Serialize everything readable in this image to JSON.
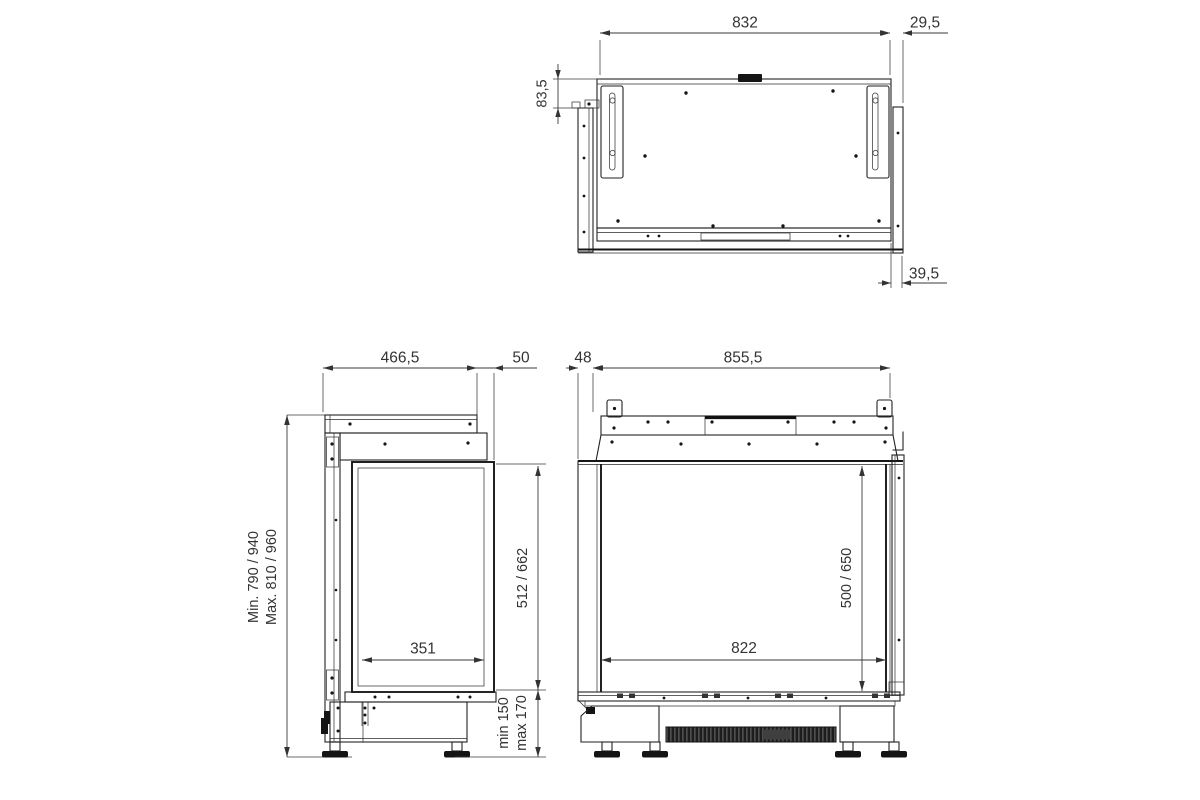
{
  "colors": {
    "background": "#ffffff",
    "line": "#222222",
    "dimension": "#3a3a3a"
  },
  "dims": {
    "top_width": "832",
    "top_right_upper": "29,5",
    "top_side_inset": "83,5",
    "top_right_lower": "39,5",
    "side_depth": "466,5",
    "side_glass_offset": "50",
    "side_height_min": "Min. 790 / 940",
    "side_height_max": "Max. 810 / 960",
    "side_glass_width": "351",
    "side_glass_height": "512 / 662",
    "side_plinth_min": "min 150",
    "side_plinth_max": "max 170",
    "front_left_offset": "48",
    "front_width": "855,5",
    "front_glass_height": "500 / 650",
    "front_glass_width": "822"
  }
}
